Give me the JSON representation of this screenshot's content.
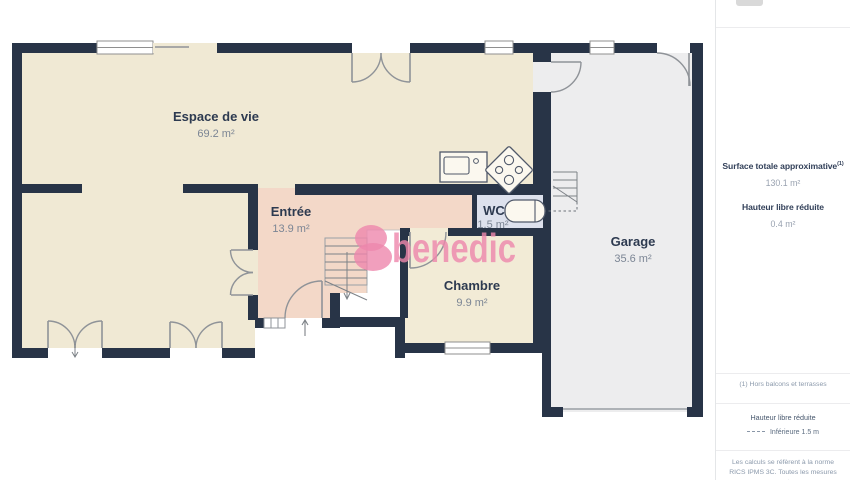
{
  "plan": {
    "watermark_text": "benedic",
    "rooms": [
      {
        "name": "Espace de vie",
        "area": "69.2 m²"
      },
      {
        "name": "Entrée",
        "area": "13.9 m²"
      },
      {
        "name": "WC",
        "area": "1.5 m²"
      },
      {
        "name": "Chambre",
        "area": "9.9 m²"
      },
      {
        "name": "Garage",
        "area": "35.6 m²"
      }
    ],
    "colors": {
      "wall": "#283447",
      "living": "#f0e9d4",
      "entree": "#f3d8c8",
      "wc": "#dde1ed",
      "chambre": "#f2ebd6",
      "garage": "#ededee",
      "watermark": "#ee87ac"
    }
  },
  "sidebar": {
    "surface_title": "Surface totale approximative",
    "surface_footnote_mark": "(1)",
    "surface_value": "130.1 m²",
    "reduced_height_title": "Hauteur libre réduite",
    "reduced_height_value": "0.4 m²",
    "footnote": "(1) Hors balcons et terrasses",
    "legend_title": "Hauteur libre réduite",
    "legend_label": "Inférieure 1.5 m",
    "disclaimer": "Les calculs se réfèrent à la norme RICS IPMS 3C. Toutes les mesures sont"
  }
}
